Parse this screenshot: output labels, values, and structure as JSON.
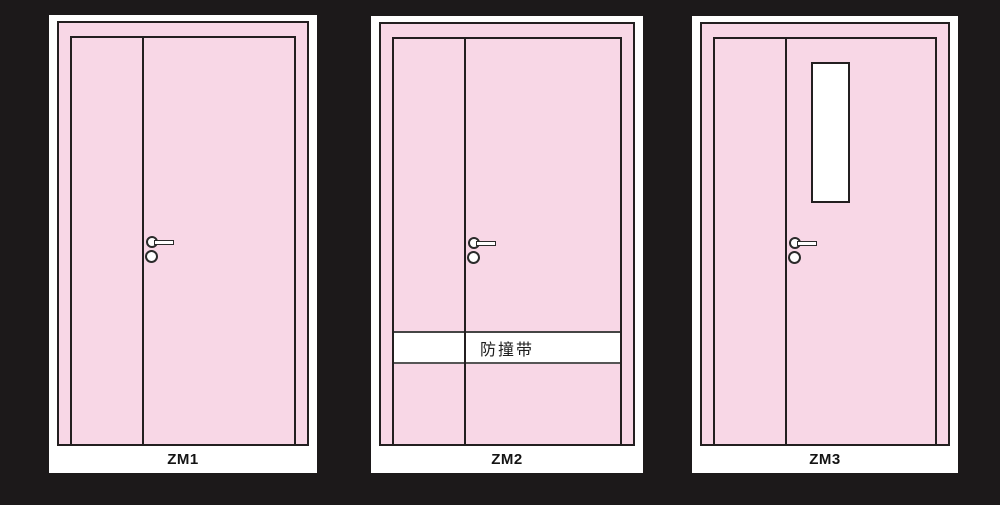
{
  "drawing": {
    "doors": [
      {
        "id": "zm1",
        "label": "ZM1"
      },
      {
        "id": "zm2",
        "label": "ZM2",
        "band_text": "防撞带"
      },
      {
        "id": "zm3",
        "label": "ZM3"
      }
    ],
    "colors": {
      "background": "#1c191a",
      "paper": "#ffffff",
      "door_pink": "#f8d7e6",
      "outline": "#231f20"
    }
  }
}
